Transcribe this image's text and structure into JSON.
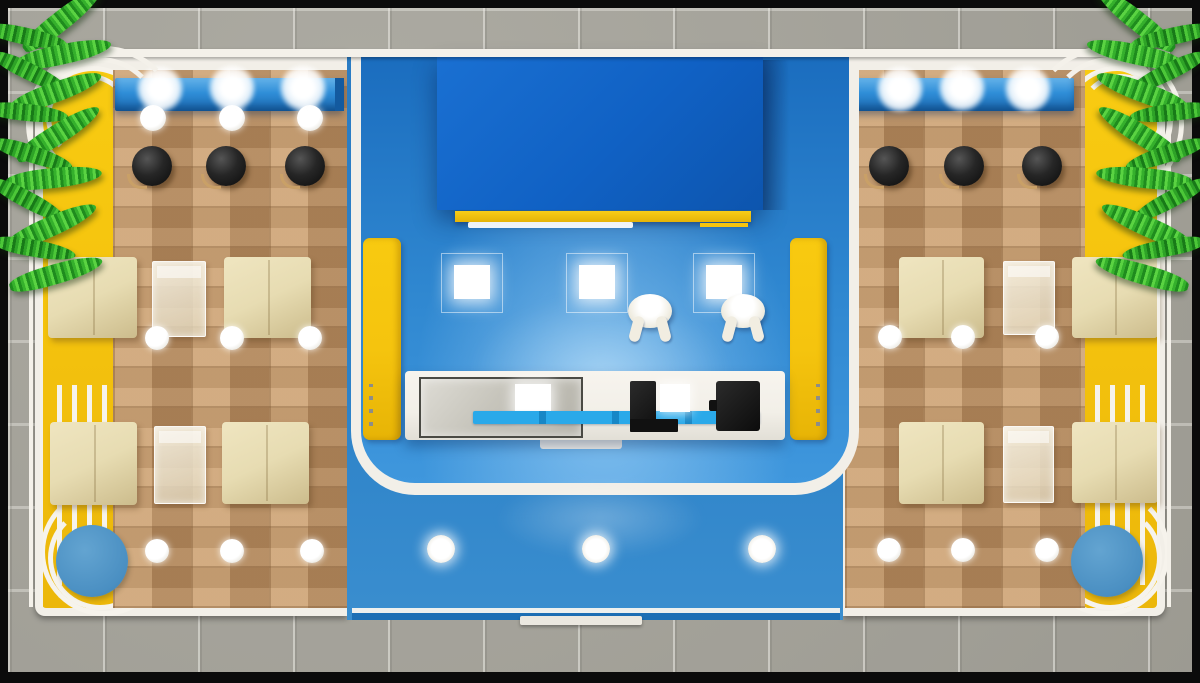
{
  "scene": {
    "subject": "3D top view render of an exhibition cafe booth with two wooden lounge wings and a central blue service stage",
    "counts": {
      "signage_spotlights": 6,
      "ceiling_lights_left_wing": 3,
      "bar_stools": 6,
      "sofa_seats": 8,
      "glass_tables": 4,
      "floor_lights": 12,
      "round_blue_tables": 2,
      "wall_light_panels": 3,
      "visitor_figures": 2,
      "yellow_pillars": 2,
      "apron_spotlights": 3,
      "palm_plants": 2,
      "counter_machines": 2
    }
  },
  "colors": {
    "frame": "#0b0b0b",
    "pavement": "#a6a49b",
    "deck": "#f2efe8",
    "yellow": "#f5c40e",
    "wood": "#c09467",
    "signage": "#2f8ed8",
    "canopy": "#1061c4",
    "stage": "#2f87d0",
    "apron": "#2d82c8",
    "cyan": "#2aa9e9",
    "stool": "#1d1d1d",
    "sofa": "#e7dcb2",
    "pool": "#4a8fc2",
    "palm": "#35b02c"
  },
  "furniture": [
    {
      "type": "glow",
      "name": "signage-spotlight",
      "x": 160,
      "y": 89,
      "r": 24
    },
    {
      "type": "glow",
      "name": "signage-spotlight",
      "x": 232,
      "y": 88,
      "r": 24
    },
    {
      "type": "glow",
      "name": "signage-spotlight",
      "x": 303,
      "y": 88,
      "r": 24
    },
    {
      "type": "glow",
      "name": "signage-spotlight",
      "x": 900,
      "y": 89,
      "r": 24
    },
    {
      "type": "glow",
      "name": "signage-spotlight",
      "x": 962,
      "y": 88,
      "r": 24
    },
    {
      "type": "glow",
      "name": "signage-spotlight",
      "x": 1028,
      "y": 89,
      "r": 24
    },
    {
      "type": "dot",
      "name": "ceiling-light",
      "x": 153,
      "y": 118,
      "r": 13
    },
    {
      "type": "dot",
      "name": "ceiling-light",
      "x": 232,
      "y": 118,
      "r": 13
    },
    {
      "type": "dot",
      "name": "ceiling-light",
      "x": 310,
      "y": 118,
      "r": 13
    },
    {
      "type": "stool",
      "name": "bar-stool",
      "x": 152,
      "y": 166,
      "r": 20
    },
    {
      "type": "stool",
      "name": "bar-stool",
      "x": 226,
      "y": 166,
      "r": 20
    },
    {
      "type": "stool",
      "name": "bar-stool",
      "x": 305,
      "y": 166,
      "r": 20
    },
    {
      "type": "stool",
      "name": "bar-stool",
      "x": 889,
      "y": 166,
      "r": 20
    },
    {
      "type": "stool",
      "name": "bar-stool",
      "x": 964,
      "y": 166,
      "r": 20
    },
    {
      "type": "stool",
      "name": "bar-stool",
      "x": 1042,
      "y": 166,
      "r": 20
    },
    {
      "type": "sofa",
      "name": "sofa-seat",
      "x": 48,
      "y": 257,
      "w": 89,
      "h": 81
    },
    {
      "type": "sofa",
      "name": "sofa-seat",
      "x": 224,
      "y": 257,
      "w": 87,
      "h": 81
    },
    {
      "type": "sofa",
      "name": "sofa-seat",
      "x": 50,
      "y": 422,
      "w": 87,
      "h": 83
    },
    {
      "type": "sofa",
      "name": "sofa-seat",
      "x": 222,
      "y": 422,
      "w": 87,
      "h": 82
    },
    {
      "type": "sofa",
      "name": "sofa-seat",
      "x": 899,
      "y": 257,
      "w": 85,
      "h": 81
    },
    {
      "type": "sofa",
      "name": "sofa-seat",
      "x": 1072,
      "y": 257,
      "w": 86,
      "h": 81
    },
    {
      "type": "sofa",
      "name": "sofa-seat",
      "x": 899,
      "y": 422,
      "w": 85,
      "h": 82
    },
    {
      "type": "sofa",
      "name": "sofa-seat",
      "x": 1072,
      "y": 422,
      "w": 86,
      "h": 81
    },
    {
      "type": "gtable",
      "name": "glass-table",
      "x": 152,
      "y": 261,
      "w": 52,
      "h": 74
    },
    {
      "type": "gtable",
      "name": "glass-table",
      "x": 154,
      "y": 426,
      "w": 50,
      "h": 76
    },
    {
      "type": "gtable",
      "name": "glass-table",
      "x": 1003,
      "y": 261,
      "w": 50,
      "h": 72
    },
    {
      "type": "gtable",
      "name": "glass-table",
      "x": 1003,
      "y": 426,
      "w": 49,
      "h": 75
    },
    {
      "type": "dot",
      "name": "floor-light",
      "x": 157,
      "y": 338,
      "r": 12
    },
    {
      "type": "dot",
      "name": "floor-light",
      "x": 232,
      "y": 338,
      "r": 12
    },
    {
      "type": "dot",
      "name": "floor-light",
      "x": 310,
      "y": 338,
      "r": 12
    },
    {
      "type": "dot",
      "name": "floor-light",
      "x": 157,
      "y": 551,
      "r": 12
    },
    {
      "type": "dot",
      "name": "floor-light",
      "x": 232,
      "y": 551,
      "r": 12
    },
    {
      "type": "dot",
      "name": "floor-light",
      "x": 312,
      "y": 551,
      "r": 12
    },
    {
      "type": "dot",
      "name": "floor-light",
      "x": 890,
      "y": 337,
      "r": 12
    },
    {
      "type": "dot",
      "name": "floor-light",
      "x": 963,
      "y": 337,
      "r": 12
    },
    {
      "type": "dot",
      "name": "floor-light",
      "x": 1047,
      "y": 337,
      "r": 12
    },
    {
      "type": "dot",
      "name": "floor-light",
      "x": 889,
      "y": 550,
      "r": 12
    },
    {
      "type": "dot",
      "name": "floor-light",
      "x": 963,
      "y": 550,
      "r": 12
    },
    {
      "type": "dot",
      "name": "floor-light",
      "x": 1047,
      "y": 550,
      "r": 12
    },
    {
      "type": "rtable",
      "name": "round-blue-table",
      "x": 92,
      "y": 561,
      "r": 36
    },
    {
      "type": "rtable",
      "name": "round-blue-table",
      "x": 1107,
      "y": 561,
      "r": 36
    },
    {
      "type": "panel",
      "name": "wall-light-panel",
      "x": 441,
      "y": 253,
      "w": 60,
      "h": 58
    },
    {
      "type": "panel",
      "name": "wall-light-panel",
      "x": 566,
      "y": 253,
      "w": 60,
      "h": 58
    },
    {
      "type": "panel",
      "name": "wall-light-panel",
      "x": 693,
      "y": 253,
      "w": 60,
      "h": 58
    },
    {
      "type": "figure",
      "name": "visitor-figure",
      "x": 628,
      "y": 294,
      "w": 44,
      "h": 34
    },
    {
      "type": "figure",
      "name": "visitor-figure",
      "x": 721,
      "y": 294,
      "w": 44,
      "h": 34
    },
    {
      "type": "pillar",
      "name": "yellow-pillar",
      "x": 363,
      "y": 238,
      "w": 38,
      "h": 202
    },
    {
      "type": "pillar",
      "name": "yellow-pillar",
      "cls": "right",
      "x": 790,
      "y": 238,
      "w": 37,
      "h": 202
    },
    {
      "type": "biglight",
      "name": "apron-spotlight",
      "x": 441,
      "y": 549,
      "r": 14
    },
    {
      "type": "biglight",
      "name": "apron-spotlight",
      "x": 596,
      "y": 549,
      "r": 14
    },
    {
      "type": "biglight",
      "name": "apron-spotlight",
      "x": 762,
      "y": 549,
      "r": 14
    }
  ]
}
